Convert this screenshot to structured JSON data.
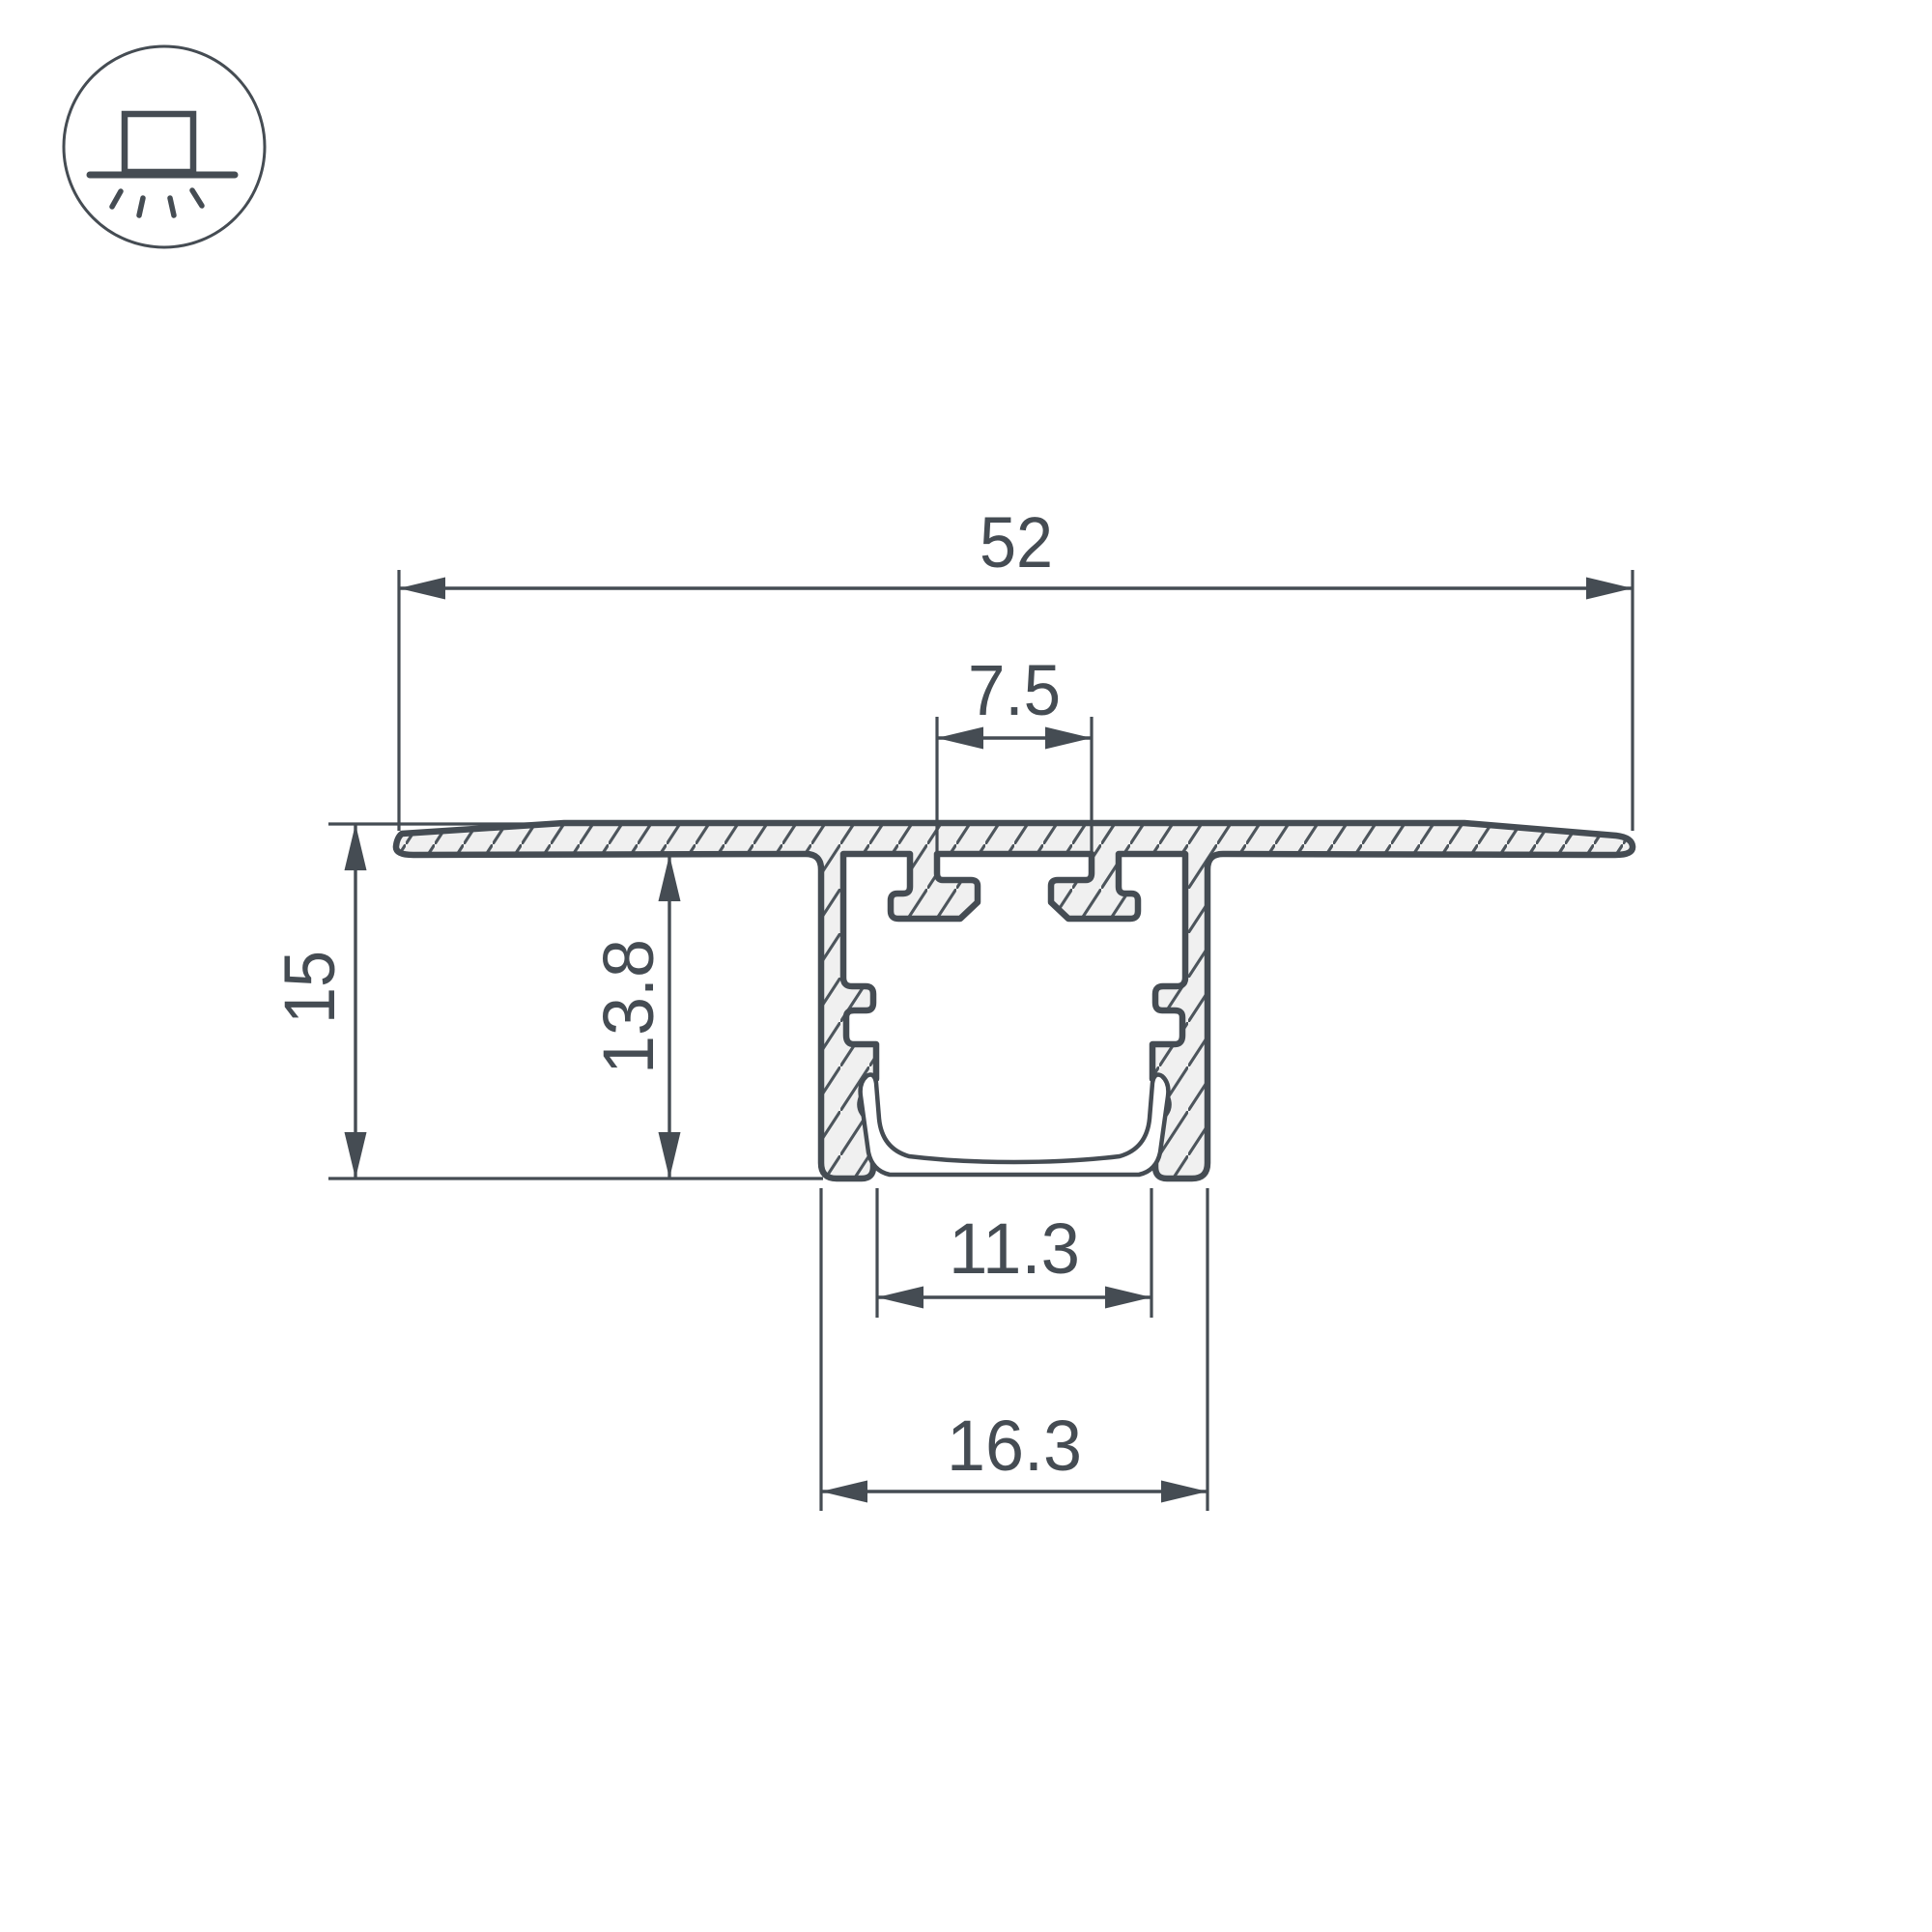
{
  "icon": {
    "name": "recessed-mount-light-icon"
  },
  "colors": {
    "line": "#454C53",
    "hatch_line": "#4D555C",
    "material_fill": "#F0F0F0",
    "background": "#FFFFFF"
  },
  "dimensions": {
    "overall_width": "52",
    "slot_width": "7.5",
    "overall_height": "15",
    "recess_depth": "13.8",
    "inner_width": "11.3",
    "channel_outer_width": "16.3"
  }
}
